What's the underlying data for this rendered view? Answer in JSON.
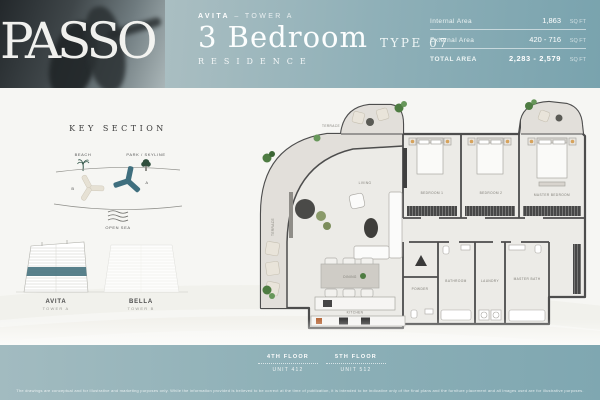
{
  "brand": {
    "logo": "PASSO"
  },
  "header": {
    "project": "AVITA",
    "tower": "– TOWER A",
    "title": "3 Bedroom",
    "type": "TYPE 07",
    "subtitle": "RESIDENCE",
    "areas": {
      "internal": {
        "label": "Internal Area",
        "value": "1,863",
        "unit": "SQ FT"
      },
      "external": {
        "label": "External Area",
        "value": "420 - 716",
        "unit": "SQ FT"
      },
      "total": {
        "label": "TOTAL AREA",
        "value": "2,283 - 2,579",
        "unit": "SQ FT"
      }
    }
  },
  "key_section": {
    "title": "KEY SECTION",
    "beach_label": "BEACH",
    "park_label": "PARK / SKYLINE",
    "tower_a_letter": "A",
    "tower_b_letter": "B",
    "open_sea_label": "OPEN SEA"
  },
  "elevations": {
    "left_name": "AVITA",
    "left_tower": "TOWER A",
    "right_name": "BELLA",
    "right_tower": "TOWER B"
  },
  "floorplan": {
    "rooms": {
      "terrace_top": "TERRACE",
      "terrace_side": "TERRACE",
      "living": "LIVING",
      "dining": "DINING",
      "kitchen": "KITCHEN",
      "bedroom1": "BEDROOM 1",
      "bedroom2": "BEDROOM 2",
      "master": "MASTER BEDROOM",
      "powder": "POWDER",
      "bathroom": "BATHROOM",
      "laundry": "LAUNDRY",
      "master_bath": "MASTER BATH"
    }
  },
  "footer": {
    "floors": [
      {
        "floor": "4TH FLOOR",
        "unit": "UNIT 412"
      },
      {
        "floor": "5TH FLOOR",
        "unit": "UNIT 512"
      }
    ],
    "disclaimer": "The drawings are conceptual and for illustrative and marketing purposes only. While the information provided is believed to be correct at the time of publication, it is intended to be indicative only of the final plans and the furniture placement and all images used are for illustrative purposes."
  },
  "colors": {
    "accent_teal": "#3f6f7e",
    "band_teal": "#8fb1b8",
    "beige": "#e6e1d4",
    "wall": "#4d4d4d"
  }
}
